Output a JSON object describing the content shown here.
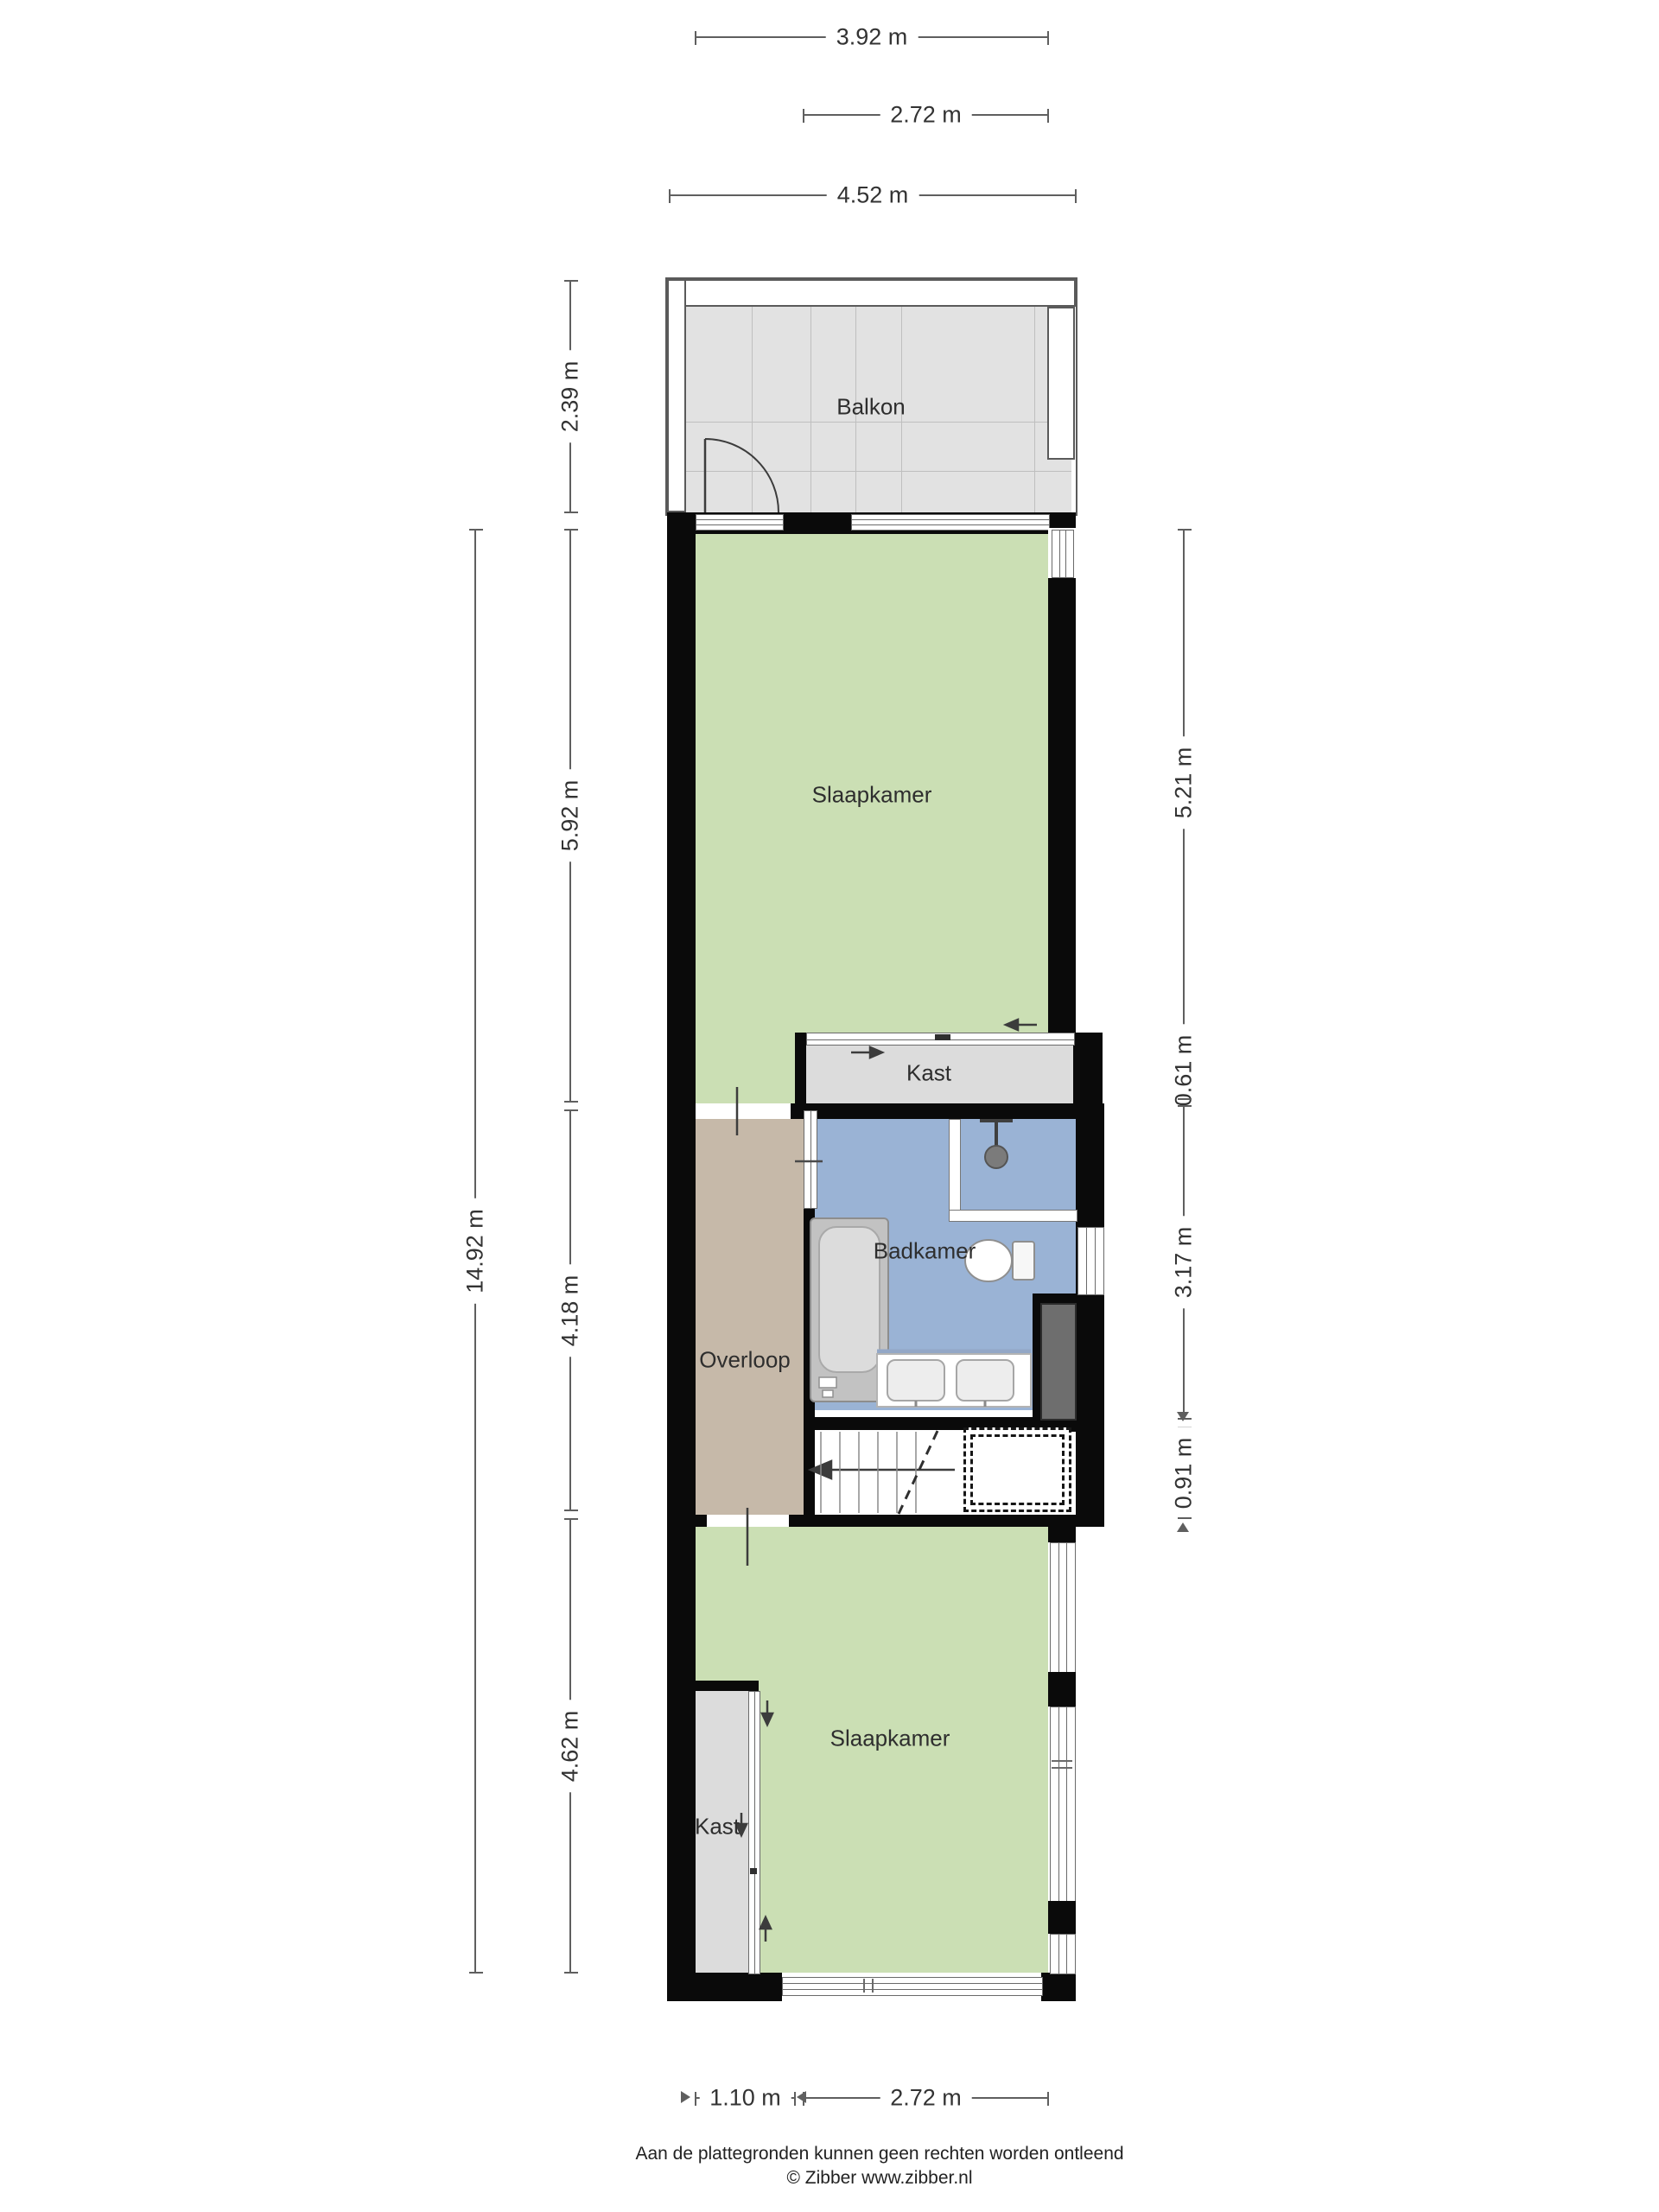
{
  "rooms": [
    {
      "name": "balkon",
      "label": "Balkon"
    },
    {
      "name": "slaapkamer-boven",
      "label": "Slaapkamer"
    },
    {
      "name": "kast-boven",
      "label": "Kast"
    },
    {
      "name": "badkamer",
      "label": "Badkamer"
    },
    {
      "name": "overloop",
      "label": "Overloop"
    },
    {
      "name": "slaapkamer-onder",
      "label": "Slaapkamer"
    },
    {
      "name": "kast-onder",
      "label": "Kast"
    }
  ],
  "dimensions": {
    "top": [
      {
        "label": "3.92 m"
      },
      {
        "label": "2.72 m"
      },
      {
        "label": "4.52 m"
      }
    ],
    "bottom": [
      {
        "label": "1.10 m"
      },
      {
        "label": "2.72 m"
      }
    ],
    "left": [
      {
        "label": "2.39 m"
      },
      {
        "label": "14.92 m"
      },
      {
        "label": "5.92 m"
      },
      {
        "label": "4.18 m"
      },
      {
        "label": "4.62 m"
      }
    ],
    "right": [
      {
        "label": "5.21 m"
      },
      {
        "label": "0.61 m"
      },
      {
        "label": "3.17 m"
      },
      {
        "label": "0.91 m"
      }
    ]
  },
  "footer": {
    "disclaimer": "Aan de plattegronden kunnen geen rechten worden ontleend",
    "copyright": "© Zibber www.zibber.nl"
  },
  "colors": {
    "bedroom": "#cbdfb4",
    "bathroom": "#9ab3d5",
    "hallway": "#c6b9a9",
    "closet": "#dcdcdc",
    "balcony": "#e2e2e2",
    "duct": "#6e6e6e",
    "wall": "#0a0a0a"
  }
}
